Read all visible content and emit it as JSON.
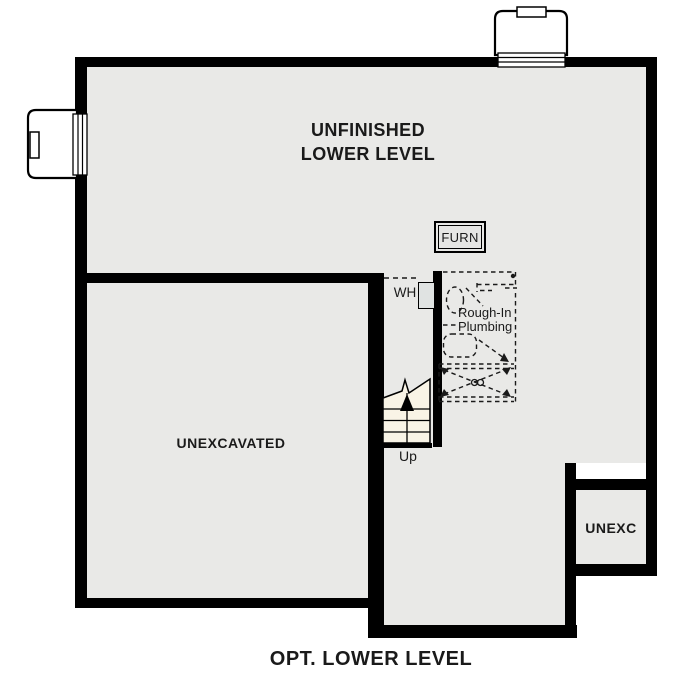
{
  "plan": {
    "main_room": {
      "line1": "UNFINISHED",
      "line2": "LOWER LEVEL"
    },
    "rooms": {
      "unexcavated": "UNEXCAVATED",
      "unexc_small": "UNEXC"
    },
    "fixtures": {
      "furnace": "FURN",
      "water_heater": "WH",
      "rough_in_line1": "Rough-In",
      "rough_in_line2": "Plumbing"
    },
    "stairs": {
      "up": "Up"
    },
    "caption": "OPT. LOWER LEVEL",
    "colors": {
      "wall": "#000000",
      "floor": "#e9e9e7",
      "stair_fill": "#f9f4e6",
      "text": "#1a1a1a",
      "background": "#ffffff"
    }
  }
}
